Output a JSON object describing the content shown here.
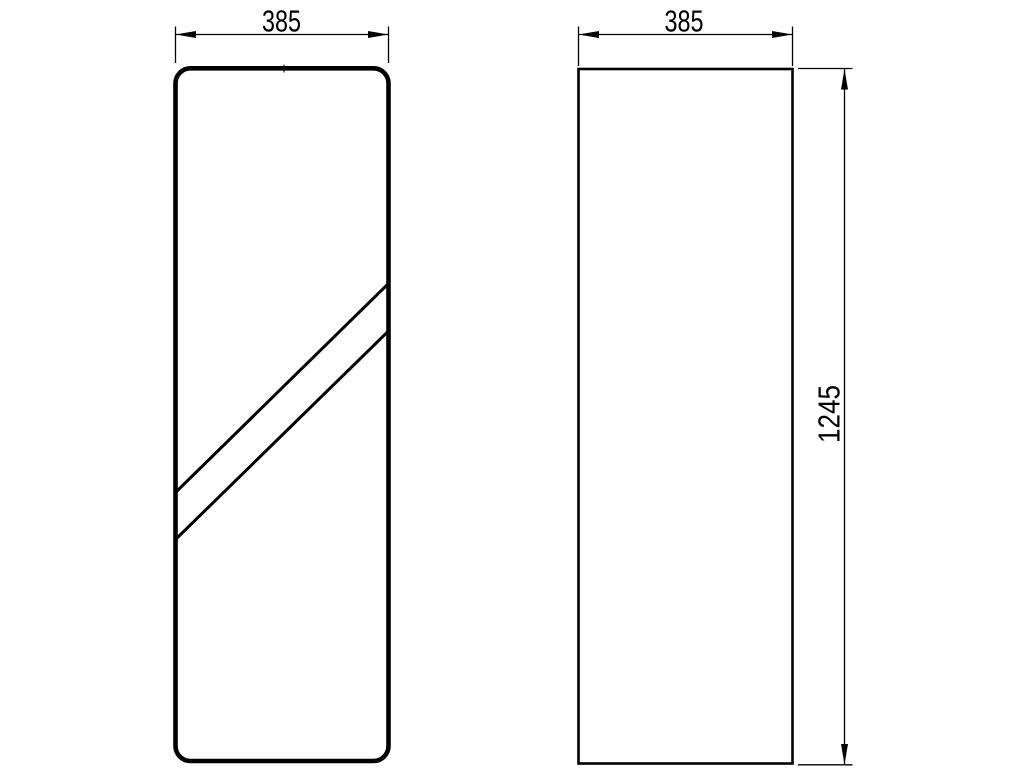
{
  "drawing": {
    "front_view": {
      "width_label": "385"
    },
    "side_view": {
      "width_label": "385",
      "height_label": "1245"
    },
    "colors": {
      "line": "#000000",
      "background": "#ffffff"
    }
  }
}
